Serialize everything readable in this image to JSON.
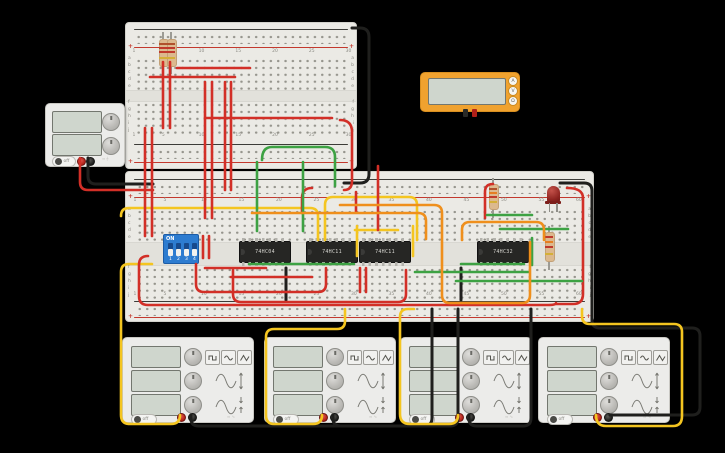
{
  "canvas": {
    "background": "#000000"
  },
  "colors": {
    "wire_red": "#d22f27",
    "wire_black": "#1f1f1d",
    "wire_yellow": "#f4c520",
    "wire_green": "#3da243",
    "wire_orange": "#ef8f1c",
    "board": "#ebeae5",
    "rail_red": "#c3392e",
    "multimeter_body": "#f0a22f",
    "dip_blue": "#2d7cd0",
    "led_red": "#8e2420"
  },
  "breadboards": {
    "small": {
      "columns": [
        1,
        5,
        10,
        15,
        20,
        25,
        30
      ],
      "letters_top": [
        "a",
        "b",
        "c",
        "d",
        "e"
      ],
      "letters_bottom": [
        "f",
        "g",
        "h",
        "i",
        "j"
      ],
      "plus": "+"
    },
    "main": {
      "columns": [
        1,
        5,
        10,
        15,
        20,
        25,
        30,
        35,
        40,
        45,
        50,
        55,
        60
      ],
      "letters_top": [
        "a",
        "b",
        "c",
        "d",
        "e"
      ],
      "letters_bottom": [
        "f",
        "g",
        "h",
        "i",
        "j"
      ],
      "plus": "+"
    }
  },
  "power_supply": {
    "power_label": "off"
  },
  "multimeter": {
    "buttons": [
      "A",
      "V",
      "Ω"
    ]
  },
  "dip_switch": {
    "on_label": "ON",
    "positions": [
      "1",
      "2",
      "3",
      "4"
    ]
  },
  "ics": [
    {
      "label": "74HC04"
    },
    {
      "label": "74HC11"
    },
    {
      "label": "74HC11"
    },
    {
      "label": "74HC32"
    }
  ],
  "function_generators": [
    {
      "power_label": "off"
    },
    {
      "power_label": "off"
    },
    {
      "power_label": "off"
    },
    {
      "power_label": "off"
    }
  ],
  "circuit": {
    "wires": [
      {
        "c": "black",
        "d": "M88,158 V176 Q88,184 96,184 H153"
      },
      {
        "c": "red",
        "d": "M80,158 V182 Q80,190 88,190 H153"
      },
      {
        "c": "black",
        "d": "M352,28 H360 Q369,28 369,37 V174 Q369,183 360,183 H344"
      },
      {
        "c": "black",
        "d": "M560,183 H584 Q592,183 592,191 V320 Q592,328 600,328 H692 Q700,328 700,336 V407 Q700,415 692,415 H610"
      },
      {
        "c": "black",
        "d": "M191,415 V419 Q191,426 199,426 H424 Q432,426 432,418 V309"
      },
      {
        "c": "black",
        "d": "M333,415 V419 Q333,426 341,426 H450 Q458,426 458,418 V309"
      },
      {
        "c": "black",
        "d": "M469,415 V419 Q469,426 477,426 H523 Q531,426 531,418 V309"
      },
      {
        "c": "black",
        "d": "M286,268 V300"
      },
      {
        "c": "black",
        "d": "M461,268 V300"
      },
      {
        "c": "yellow",
        "d": "M180,415 Q180,424 171,424 H130 Q121,424 121,415 V272 Q121,264 129,264 H152"
      },
      {
        "c": "yellow",
        "d": "M322,415 Q322,424 313,424 H274 Q266,424 266,415 V337 Q266,329 274,329 H337 Q345,329 345,321 V309"
      },
      {
        "c": "yellow",
        "d": "M458,415 Q458,424 449,424 H410 Q400,424 400,414 V317 Q400,309 408,309 H414"
      },
      {
        "c": "yellow",
        "d": "M596,415 Q596,426 606,426 H673 Q682,426 682,416 V332 Q682,324 674,324 H590 Q582,324 582,316 V309"
      },
      {
        "c": "yellow",
        "d": "M121,216 Q121,208 129,208 H310 Q318,208 318,216 V240"
      },
      {
        "c": "yellow",
        "d": "M325,240 V205 Q325,197 333,197 H409 Q417,197 417,205 V240"
      },
      {
        "c": "yellow",
        "d": "M355,230 H398"
      },
      {
        "c": "yellow",
        "d": "M357,226 V256"
      },
      {
        "c": "yellow",
        "d": "M413,226 V256"
      },
      {
        "c": "red",
        "d": "M145,128 V236"
      },
      {
        "c": "red",
        "d": "M152,128 V236"
      },
      {
        "c": "red",
        "d": "M163,62 V128"
      },
      {
        "c": "red",
        "d": "M170,62 V128"
      },
      {
        "c": "red",
        "d": "M205,82 V218"
      },
      {
        "c": "red",
        "d": "M212,82 V218"
      },
      {
        "c": "red",
        "d": "M225,82 V190"
      },
      {
        "c": "red",
        "d": "M231,82 V190"
      },
      {
        "c": "red",
        "d": "M203,236 V258"
      },
      {
        "c": "red",
        "d": "M209,236 V258"
      },
      {
        "c": "red",
        "d": "M177,68 H250"
      },
      {
        "c": "red",
        "d": "M150,77 H235"
      },
      {
        "c": "red",
        "d": "M205,118 H332"
      },
      {
        "c": "red",
        "d": "M340,120 Q352,120 352,132 V181 Q352,190 344,190"
      },
      {
        "c": "red",
        "d": "M378,166 V230"
      },
      {
        "c": "red",
        "d": "M356,192 V212"
      },
      {
        "c": "red",
        "d": "M312,188 Q302,188 302,198 V213"
      },
      {
        "c": "red",
        "d": "M493,184 Q485,184 485,192 V218"
      },
      {
        "c": "red",
        "d": "M567,188 Q583,188 583,198 V294 Q583,304 573,304 H556"
      },
      {
        "c": "red",
        "d": "M148,256 Q139,256 139,265 V296 Q139,305 148,305 H548 Q556,305 556,303"
      },
      {
        "c": "red",
        "d": "M196,264 V284 Q196,292 204,292 H318 Q326,292 326,284 V268"
      },
      {
        "c": "red",
        "d": "M233,270 V294 Q233,302 241,302 H398 Q406,302 406,294 V270"
      },
      {
        "c": "red",
        "d": "M205,268 H266"
      },
      {
        "c": "red",
        "d": "M231,277 H312"
      },
      {
        "c": "red",
        "d": "M360,268 V292"
      },
      {
        "c": "red",
        "d": "M366,268 V292"
      },
      {
        "c": "green",
        "d": "M262,160 Q262,147 272,147 H325 Q335,147 335,157 V186"
      },
      {
        "c": "green",
        "d": "M257,162 V231"
      },
      {
        "c": "green",
        "d": "M303,162 V231"
      },
      {
        "c": "green",
        "d": "M249,264 H354"
      },
      {
        "c": "green",
        "d": "M461,264 H524"
      },
      {
        "c": "green",
        "d": "M415,272 H528"
      },
      {
        "c": "green",
        "d": "M456,281 H582"
      },
      {
        "c": "green",
        "d": "M487,215 H532"
      },
      {
        "c": "green",
        "d": "M500,229 H568"
      },
      {
        "c": "green",
        "d": "M532,238 V265"
      },
      {
        "c": "orange",
        "d": "M252,213 H418 Q426,213 426,221 V239"
      },
      {
        "c": "orange",
        "d": "M340,205 H434 Q442,205 442,213 V295 Q442,303 450,303 H522 Q530,303 530,295 V242"
      },
      {
        "c": "orange",
        "d": "M462,240 V230 Q462,222 470,222 H536 Q544,222 544,230 V240"
      }
    ]
  }
}
